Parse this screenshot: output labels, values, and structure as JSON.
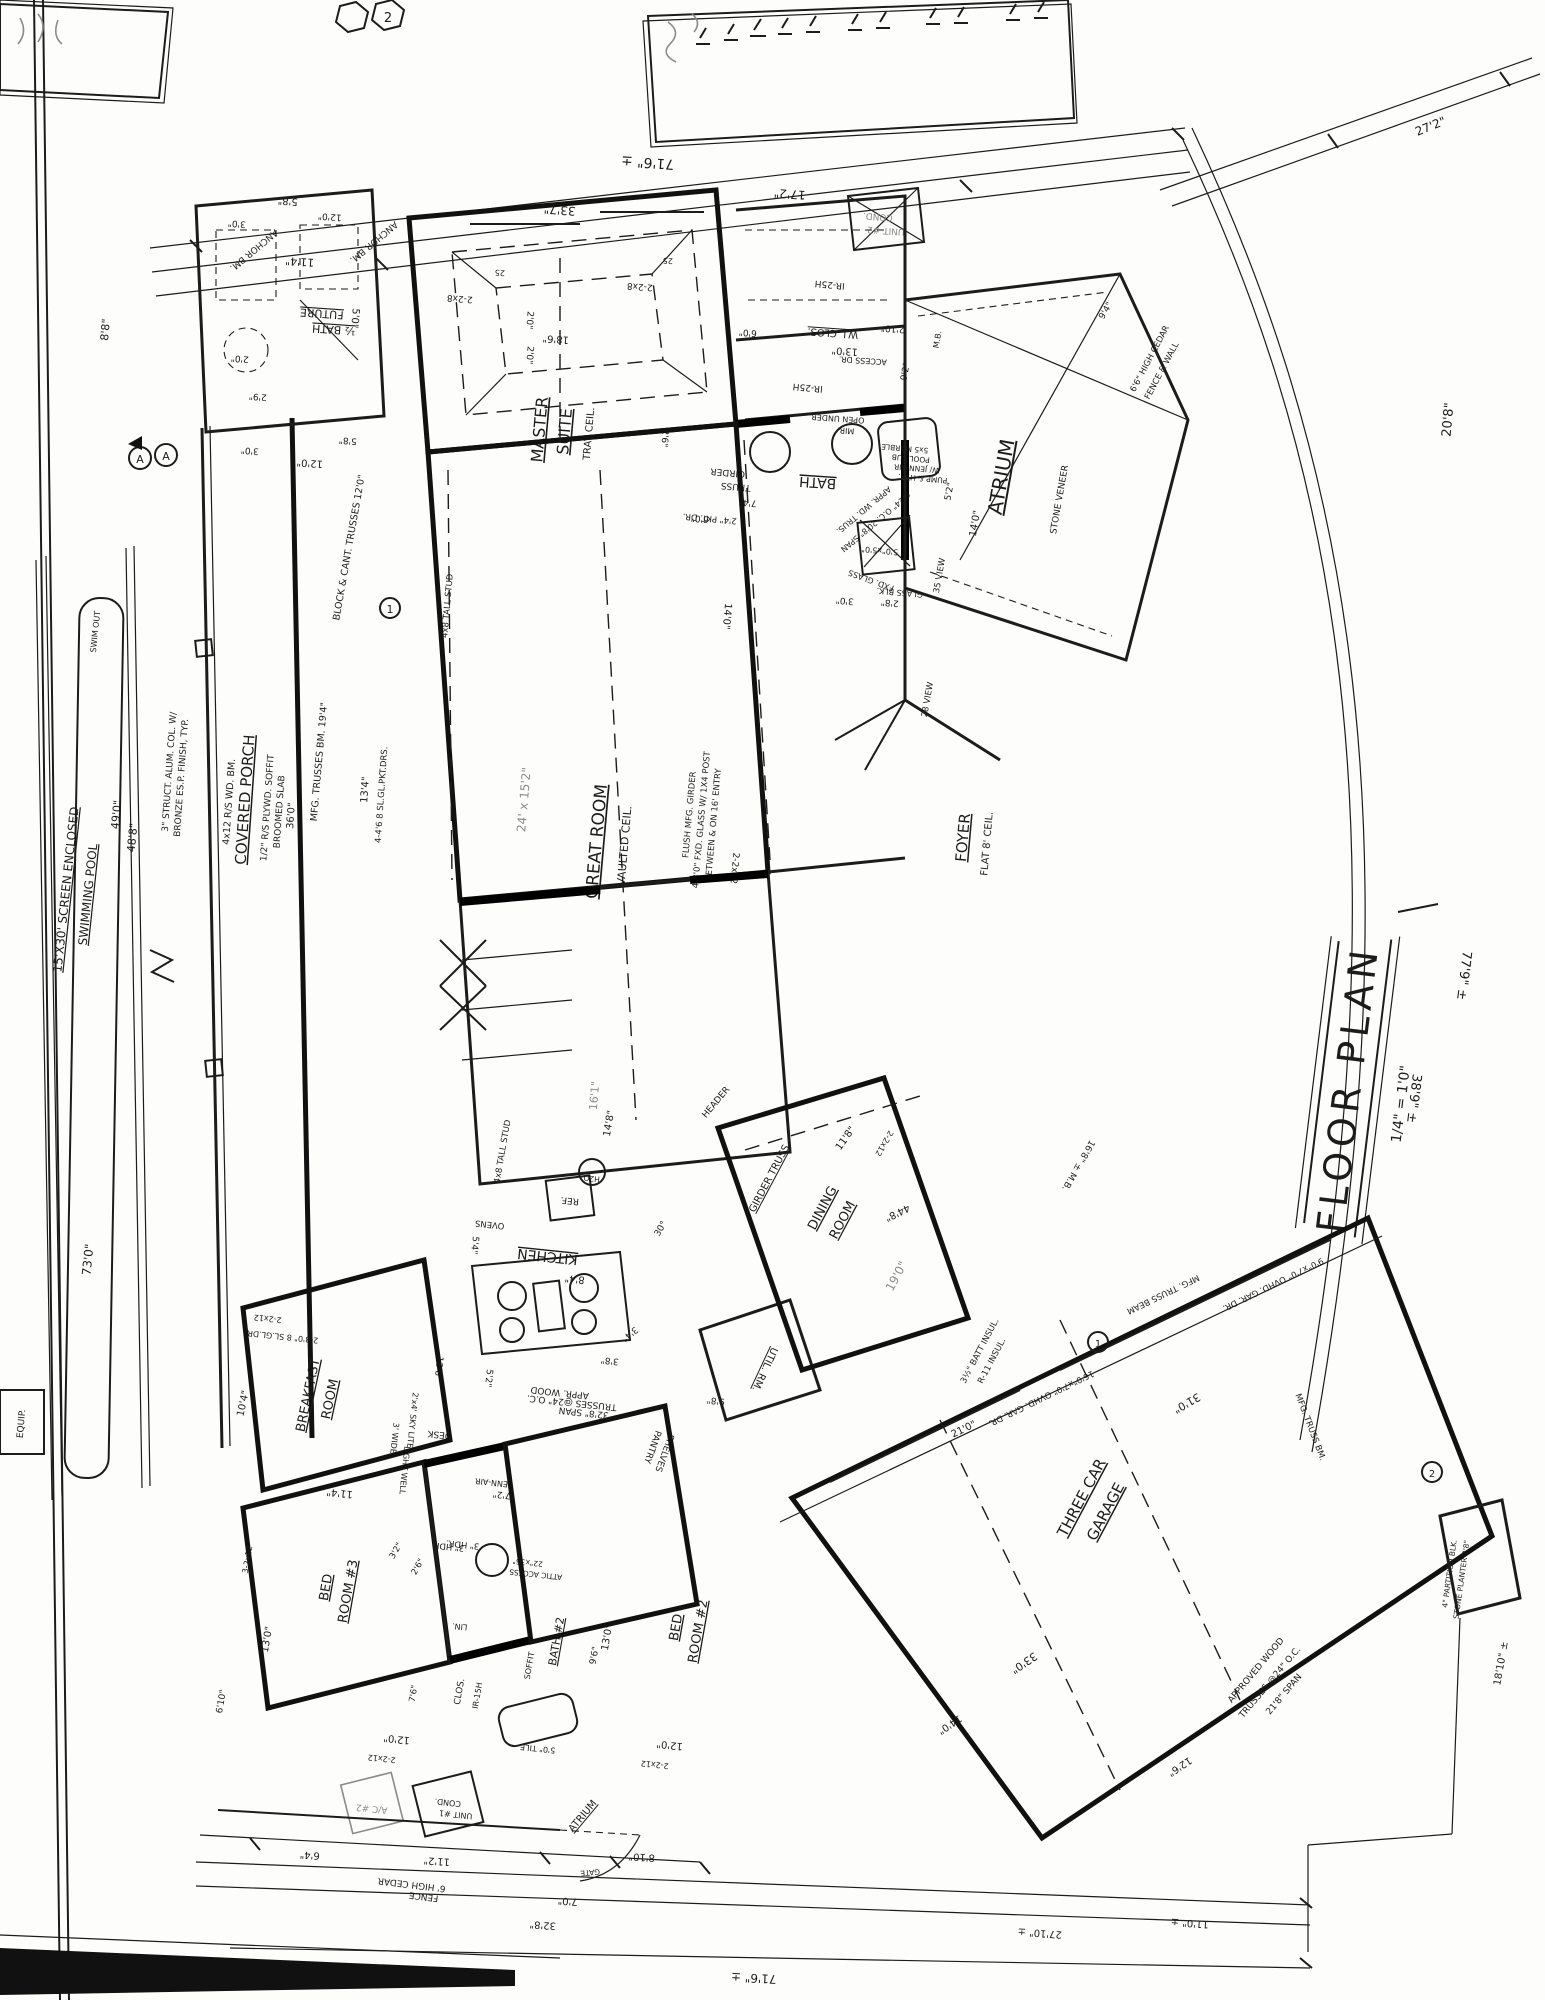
{
  "sheet": {
    "title": "FLOOR PLAN",
    "scale": "1/4\" = 1'0\"",
    "dim_right_long": "77'9\" ±",
    "dim_right_short": "38'9\" ±",
    "dim_top_right_corner": "27'2\"",
    "dim_right_top": "20'8\"",
    "marker_a": "A",
    "marker_1": "1",
    "marker_2": "2",
    "marker_3": "3"
  },
  "top_dims": {
    "overall": "71'6\" ±",
    "d1": "33'7\"",
    "d2": "17'2\"",
    "d3": "11'4\"",
    "d4": "42'0\"",
    "d5": "3'0\"",
    "d6": "9'6\"",
    "left_v": "8'8\""
  },
  "cond_unit2": {
    "l1": "COND.",
    "l2": "UNIT #2"
  },
  "pool": {
    "name1": "15'X30' SCREEN ENCLOSED",
    "name2": "SWIMMING POOL",
    "swim_out": "SWIM OUT",
    "dim_len": "73'0\"",
    "dim_a": "49'0\"",
    "dim_b": "48'8\"",
    "equip": "EQUIP."
  },
  "porch": {
    "name": "COVERED PORCH",
    "note1": "1/2\" R/S PLYWD. SOFFIT",
    "note2": "BROOMED SLAB",
    "dim": "36'0\"",
    "col1": "3\" STRUCT. ALUM. COL. W/",
    "col2": "BRONZE ES.P. FINISH, TYP.",
    "beam": "4x12 R/S WD. BM.",
    "truss1": "BLOCK & CANT. TRUSSES 12'0\"",
    "truss2": "MFG. TRUSSES BM. 19'4\"",
    "dim2": "13'4\"",
    "doors": "4-4'6 8 SL.GL.PKT.DRS."
  },
  "future": {
    "name1": "FUTURE",
    "name2": "½ BATH",
    "anchor": "ANCHOR BM.",
    "d1": "5'0\"",
    "d2": "2'9\"",
    "d3": "2'0\"",
    "d4": "5'8\"",
    "d5": "12'0\"",
    "d6": "3'0\"",
    "d7": "2'8\""
  },
  "master": {
    "name1": "MASTER",
    "name2": "SUITE",
    "ceil": "TRAY CEIL.",
    "dim": "18'6\"",
    "d1": "2'0\"",
    "d2": "2'6\"",
    "hdr": "2-2x8",
    "tick": "25"
  },
  "wic": {
    "name": "W.I. CLOS.",
    "dim": "13'0\"",
    "d1": "6'0\"",
    "d2": "2'10\"",
    "access": "ACCESS DR.",
    "ir": "IR-25H"
  },
  "bath": {
    "name": "BATH",
    "girder1": "GIRDER",
    "girder2": "TRUSS",
    "pkt": "2'4\" PKT. DR.",
    "d1": "7'4\"",
    "truss1": "APPR. WD. TRUS.",
    "truss2": "@24\" O.C. 20'8\" SPAN",
    "mir1": "OPEN UNDER",
    "mir2": "MIR.",
    "tub1": "5x5 MARBLE",
    "tub2": "POOL TUB",
    "tub3": "W/ JENN-AIR",
    "tub4": "PUMP & HTR.",
    "fxd1": "5'0\"x5'0\"",
    "fxd2": "FXD. GLASS",
    "glass": "GLASS BLK.",
    "d2": "3'0\"",
    "d3": "2'8\"",
    "d4": "6'0\""
  },
  "atrium": {
    "name": "ATRIUM",
    "d1": "14'0\"",
    "d2": "5'2\"",
    "d3": "9'2\"",
    "d4": "9'4\"",
    "view1": "35 VIEW",
    "view2": "28 VIEW",
    "mb": "M.B.",
    "fence1": "6'6\" HIGH CEDAR",
    "fence2": "FENCE & WALL",
    "stone": "STONE VENEER"
  },
  "foyer": {
    "name": "FOYER",
    "ceil": "FLAT 8' CEIL.",
    "hdr": "2-2x12",
    "angle": "30°"
  },
  "great": {
    "name1": "GREAT ROOM",
    "name2": "VAULTED CEIL.",
    "pencil": "24' x 15'2\"",
    "g1": "FLUSH MFG. GIRDER",
    "g2": "4-3'0\" FXD. GLASS W/ 1X4 POST",
    "g3": "BETWEEN & ON 16' ENTRY",
    "wall": "4x8 TALL STUD",
    "d1": "14'8\"",
    "d2": "14'0\"",
    "pencil2": "16'1\""
  },
  "kitchen": {
    "name": "KITCHEN",
    "ref": "REF.",
    "h2o": "H2O",
    "ovens": "OVENS",
    "desk": "DESK",
    "jenn": "JENN-AIR",
    "pantry1": "PANTRY",
    "pantry2": "SHELVES",
    "light1": "3' WIDE",
    "light2": "LIGHT WELL",
    "sky": "2'x4' SKY LITE",
    "truss1": "APPR. WOOD",
    "truss2": "TRUSSES @24\" O.C.",
    "truss3": "32'8\" SPAN",
    "d1": "8'4\"",
    "d2": "5'4\"",
    "d3": "5'2\"",
    "d4": "13'6\"",
    "d5": "3'4\"",
    "d6": "7'2\"",
    "d7": "3'8\"",
    "hdr3": "3\" HDR."
  },
  "breakfast": {
    "name1": "BREAKFAST",
    "name2": "ROOM",
    "d1": "10'4\"",
    "d2": "11'4\"",
    "doors": "2-3'0\" 8 SL.GL.DR.",
    "hdr": "2-2x12"
  },
  "util": {
    "name": "UTIL. RM.",
    "dim": "9'8\""
  },
  "dining": {
    "name1": "DINING",
    "name2": "ROOM",
    "pencil": "19'0\"",
    "dim": "11'8\"",
    "girder1": "GIRDER TRUSS",
    "header": "HEADER",
    "hdr2": "2-2x12",
    "mb": "16'8\" ± M.B.",
    "insul1": "3½\" BATT INSUL.",
    "insul2": "R-11 INSUL."
  },
  "garage": {
    "name1": "THREE CAR",
    "name2": "GARAGE",
    "d1": "31'0\"",
    "d2": "33'0\"",
    "d3": "21'0\"",
    "d4": "14'0\"",
    "d5": "44'8\"",
    "d6": "12'6\"",
    "truss1": "APPROVED WOOD",
    "truss2": "TRUSSES @24\" O.C.",
    "truss3": "21'8\" SPAN",
    "door1": "16'0\"x7'0\" OVHD. GAR. DR.",
    "door2": "9'0\"x7'0\" OVHD. GAR. DR.",
    "beam1": "MFG. TRUSS BEAM",
    "beam2": "MFG. TRUSS BM.",
    "planter1": "4\" PARTITION BLK.",
    "planter2": "STONE PLANTER 2'8\"",
    "dim_br": "18'10\" ±"
  },
  "bed3": {
    "name1": "BED",
    "name2": "ROOM #3",
    "d1": "13'0\"",
    "d2": "12'0\"",
    "d3": "6'10\"",
    "hdr": "2-2x12",
    "hdr2": "3-2x12"
  },
  "bed2": {
    "name1": "BED",
    "name2": "ROOM #2",
    "d1": "13'0\"",
    "d2": "12'0\"",
    "hdr": "2-2x12"
  },
  "bath2": {
    "name": "BATH #2",
    "soffit": "SOFFIT",
    "dim": "9'6\"",
    "tile": "5'0\" TILE",
    "lin": "LIN.",
    "clos": "CLOS.",
    "ir": "IR-15H",
    "attic1": "22\"x36\"",
    "attic2": "ATTIC ACCESS",
    "hdr": "3\" HDR.",
    "d1": "3'2\"",
    "d2": "2'6\"",
    "d3": "7'6\""
  },
  "equipment": {
    "cond1a": "COND.",
    "cond1b": "UNIT #1",
    "ac2": "A/C #2"
  },
  "fence": {
    "note1": "6' HIGH CEDAR",
    "note2": "FENCE",
    "gate": "GATE",
    "atrium": "ATRIUM",
    "d1": "6'4\"",
    "d2": "11'2\"",
    "d3": "7'0\"",
    "d4": "8'10\"",
    "d5": "32'8\"",
    "overall": "71'6\" ±",
    "d6": "27'10\" ±",
    "d7": "11'0\" ±"
  }
}
